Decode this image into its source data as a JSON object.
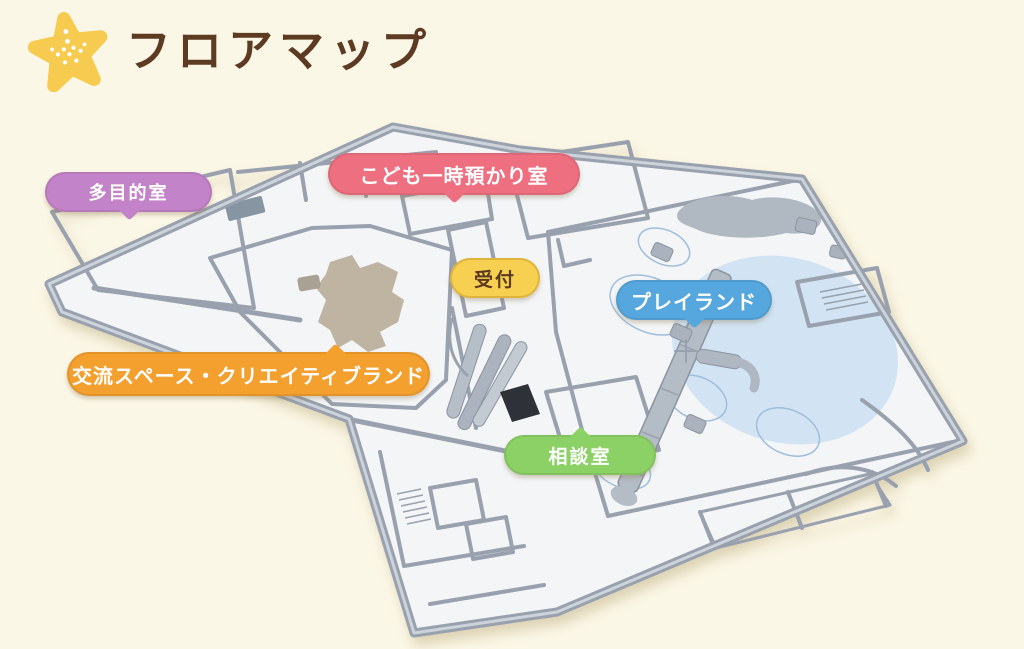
{
  "header": {
    "title": "フロアマップ",
    "title_color": "#5D3B22",
    "star_color": "#F6CB4F"
  },
  "map": {
    "floor_color": "#F3F5F7",
    "wall_color": "#98A1AD",
    "island_color": "#BFB3A2",
    "labels": [
      {
        "id": "tamokuteki",
        "text": "多目的室",
        "color": "#C383C9",
        "text_color": "#FFFFFF",
        "tail": "bottom"
      },
      {
        "id": "kodomo-azukari",
        "text": "こども一時預かり室",
        "color": "#EE6F7F",
        "text_color": "#FFFFFF",
        "tail": "bottom"
      },
      {
        "id": "uketsuke",
        "text": "受付",
        "color": "#F8D051",
        "text_color": "#5A3A1E",
        "tail": "none"
      },
      {
        "id": "playland",
        "text": "プレイランド",
        "color": "#56A7DD",
        "text_color": "#FFFFFF",
        "tail": "bottom"
      },
      {
        "id": "kouryuu-creative",
        "text": "交流スペース・クリエイティブランド",
        "color": "#F4A02F",
        "text_color": "#FFFFFF",
        "tail": "top"
      },
      {
        "id": "soudan",
        "text": "相談室",
        "color": "#8CD166",
        "text_color": "#FFFFFF",
        "tail": "top"
      }
    ],
    "rooms": [
      {
        "name": "多目的室",
        "floor_color": "#EBE0F1"
      },
      {
        "name": "こども一時預かり室",
        "floor_color": "#F3C2CD"
      },
      {
        "name": "交流スペース・クリエイティブランド",
        "floor_color": "#F8DFB4"
      },
      {
        "name": "プレイランド",
        "floor_color": "#D8EAF7"
      },
      {
        "name": "相談室",
        "floor_color": "#C9E8B3"
      }
    ]
  }
}
